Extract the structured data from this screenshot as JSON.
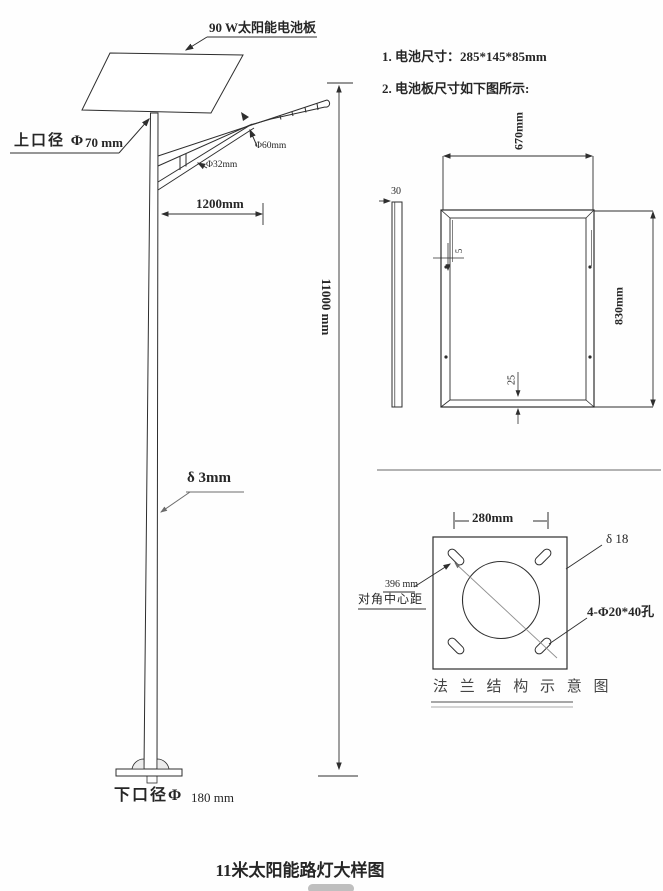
{
  "title": "11米太阳能路灯大样图",
  "notes": {
    "n1": "1. 电池尺寸：285*145*85mm",
    "n2": "2. 电池板尺寸如下图所示:"
  },
  "pole": {
    "panel_callout": "90 W太阳能电池板",
    "top_dia_label": "上口径 Φ",
    "top_dia_value": "70 mm",
    "arm_dia": "Φ60mm",
    "brace_dia": "Φ32mm",
    "arm_span": "1200mm",
    "height": "11000 mm",
    "wall": "δ 3mm",
    "bottom_dia_label": "下口径Φ",
    "bottom_dia_value": "180 mm"
  },
  "panel_view": {
    "width": "670mm",
    "height": "830mm",
    "thickness": "30",
    "lip": "5",
    "bottom_lip": "25"
  },
  "flange": {
    "spacing": "280mm",
    "thickness": "δ 18",
    "diag_value": "396 mm",
    "diag_label": "对角中心距",
    "holes": "4-Φ20*40孔",
    "caption": "法 兰 结 构 示 意 图"
  },
  "colors": {
    "line": "#2e2e2e",
    "gray": "#8c8c8c"
  }
}
